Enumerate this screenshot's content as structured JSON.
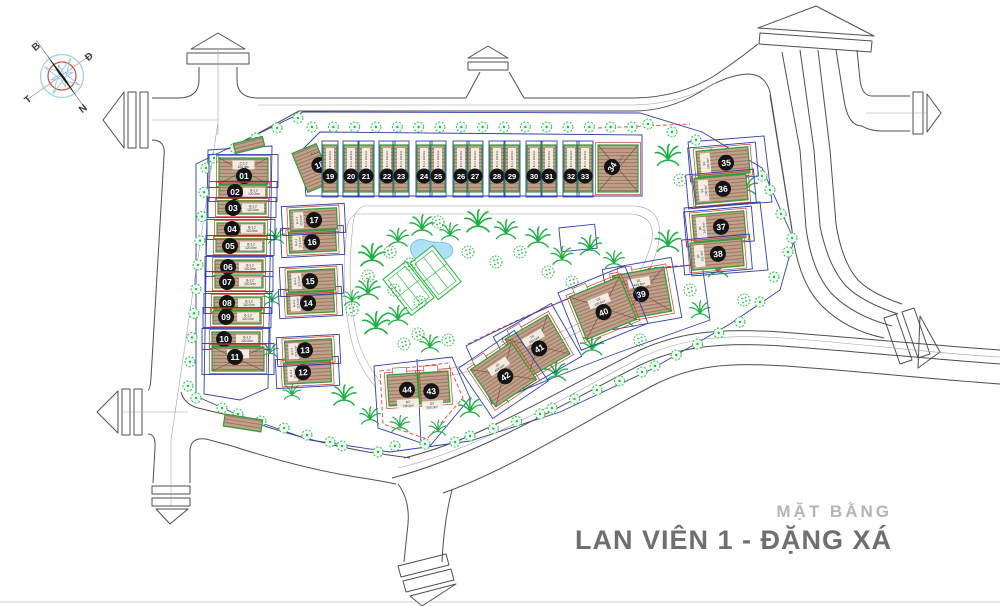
{
  "title_block": {
    "subtitle": "MẶT BẰNG",
    "title": "LAN VIÊN 1 - ĐẶNG XÁ"
  },
  "compass": {
    "north": "B",
    "east": "Đ",
    "west": "T",
    "south": "N"
  },
  "colors": {
    "building_fill": "#c2a18b",
    "building_border": "#2e9e38",
    "lot_line": "#2f3fae",
    "setback_line": "#d92b2b",
    "tree_green": "#28b948",
    "pool_blue": "#aee0f6",
    "road_line": "#4f4f4f",
    "title_gray": "#6f6f6f",
    "subtitle_gray": "#b5b5b5"
  },
  "plan": {
    "park": {
      "features": [
        "swimming-pool",
        "tennis-courts",
        "park-trees"
      ]
    },
    "plots": [
      {
        "no": "01",
        "type": "C-1.2",
        "area": "104.4m²",
        "shape": "hip",
        "bx": 219,
        "by": 158,
        "bw": 49,
        "bh": 26,
        "cx": 244,
        "cy": 176
      },
      {
        "no": "02",
        "type": "B-1.2",
        "area": "120.0m²",
        "shape": "row",
        "bx": 219,
        "by": 185,
        "bw": 48,
        "bh": 13,
        "cx": 235,
        "cy": 192
      },
      {
        "no": "03",
        "type": "B-1.2",
        "area": "120.0m²",
        "shape": "row",
        "bx": 218,
        "by": 201,
        "bw": 48,
        "bh": 13,
        "cx": 233,
        "cy": 208
      },
      {
        "no": "04",
        "type": "B-1.2",
        "area": "120.0m²",
        "shape": "row",
        "bx": 217,
        "by": 223,
        "bw": 48,
        "bh": 13,
        "cx": 232,
        "cy": 229
      },
      {
        "no": "05",
        "type": "B-1.2",
        "area": "120.0m²",
        "shape": "row",
        "bx": 216,
        "by": 239,
        "bw": 48,
        "bh": 13,
        "cx": 230,
        "cy": 246
      },
      {
        "no": "06",
        "type": "B-1.2",
        "area": "120.0m²",
        "shape": "row",
        "bx": 215,
        "by": 260,
        "bw": 48,
        "bh": 13,
        "cx": 228,
        "cy": 267
      },
      {
        "no": "07",
        "type": "B-1.2",
        "area": "120.0m²",
        "shape": "row",
        "bx": 215,
        "by": 275,
        "bw": 48,
        "bh": 13,
        "cx": 227,
        "cy": 282
      },
      {
        "no": "08",
        "type": "B-1.2",
        "area": "120.0m²",
        "shape": "row",
        "bx": 214,
        "by": 297,
        "bw": 48,
        "bh": 13,
        "cx": 227,
        "cy": 303
      },
      {
        "no": "09",
        "type": "B-1.2",
        "area": "120.0m²",
        "shape": "row",
        "bx": 213,
        "by": 311,
        "bw": 48,
        "bh": 13,
        "cx": 226,
        "cy": 317
      },
      {
        "no": "10",
        "type": "B-1.2",
        "area": "120.0m²",
        "shape": "row",
        "bx": 212,
        "by": 332,
        "bw": 48,
        "bh": 14,
        "cx": 224,
        "cy": 339
      },
      {
        "no": "11",
        "type": "C-1.2",
        "area": "110.0m²",
        "shape": "hip",
        "bx": 212,
        "by": 347,
        "bw": 52,
        "bh": 24,
        "cx": 235,
        "cy": 357
      },
      {
        "no": "12",
        "type": "B-2.1",
        "area": "215.0m²",
        "shape": "pairh",
        "bx": 284,
        "by": 362,
        "bw": 47,
        "bh": 21,
        "cx": 303,
        "cy": 372,
        "rot": -3
      },
      {
        "no": "13",
        "type": "B-2.1",
        "area": "215.0m²",
        "shape": "pairh",
        "bx": 285,
        "by": 340,
        "bw": 47,
        "bh": 21,
        "cx": 305,
        "cy": 350,
        "rot": -3
      },
      {
        "no": "14",
        "type": "B-2.1",
        "area": "215.0m²",
        "shape": "pairh",
        "bx": 287,
        "by": 292,
        "bw": 47,
        "bh": 21,
        "cx": 308,
        "cy": 303,
        "rot": -3
      },
      {
        "no": "15",
        "type": "B-2.1",
        "area": "215.0m²",
        "shape": "pairh",
        "bx": 288,
        "by": 270,
        "bw": 47,
        "bh": 21,
        "cx": 310,
        "cy": 281,
        "rot": -3
      },
      {
        "no": "16",
        "type": "B-2.1",
        "area": "215.0m²",
        "shape": "pairh",
        "bx": 289,
        "by": 231,
        "bw": 47,
        "bh": 21,
        "cx": 312,
        "cy": 242,
        "rot": -3
      },
      {
        "no": "17",
        "type": "B-2.1",
        "area": "215.0m²",
        "shape": "pairh",
        "bx": 290,
        "by": 209,
        "bw": 47,
        "bh": 21,
        "cx": 314,
        "cy": 220,
        "rot": -3
      },
      {
        "no": "18",
        "type": "C-1.1",
        "area": "158.0m²",
        "shape": "end",
        "bx": 299,
        "by": 147,
        "bw": 26,
        "bh": 42,
        "cx": 320,
        "cy": 168,
        "rot": -22
      },
      {
        "no": "19",
        "type": "B-1.1",
        "area": "132.5m²",
        "shape": "strip",
        "bx": 323,
        "by": 145,
        "bw": 14,
        "bh": 47,
        "cx": 330,
        "cy": 176
      },
      {
        "no": "20",
        "type": "B-1.1",
        "area": "132.5m²",
        "shape": "strip",
        "bx": 344,
        "by": 145,
        "bw": 14,
        "bh": 47,
        "cx": 351,
        "cy": 176
      },
      {
        "no": "21",
        "type": "B-1.1",
        "area": "132.5m²",
        "shape": "strip",
        "bx": 359,
        "by": 145,
        "bw": 14,
        "bh": 47,
        "cx": 366,
        "cy": 176
      },
      {
        "no": "22",
        "type": "B-1.1",
        "area": "132.5m²",
        "shape": "strip",
        "bx": 380,
        "by": 145,
        "bw": 14,
        "bh": 47,
        "cx": 387,
        "cy": 176
      },
      {
        "no": "23",
        "type": "B-1.1",
        "area": "132.5m²",
        "shape": "strip",
        "bx": 394,
        "by": 145,
        "bw": 14,
        "bh": 47,
        "cx": 401,
        "cy": 176
      },
      {
        "no": "24",
        "type": "B-1.1",
        "area": "132.5m²",
        "shape": "strip",
        "bx": 417,
        "by": 145,
        "bw": 14,
        "bh": 47,
        "cx": 424,
        "cy": 176
      },
      {
        "no": "25",
        "type": "B-1.1",
        "area": "132.5m²",
        "shape": "strip",
        "bx": 431,
        "by": 145,
        "bw": 14,
        "bh": 47,
        "cx": 438,
        "cy": 176
      },
      {
        "no": "26",
        "type": "B-1.1",
        "area": "132.5m²",
        "shape": "strip",
        "bx": 454,
        "by": 145,
        "bw": 14,
        "bh": 47,
        "cx": 461,
        "cy": 176
      },
      {
        "no": "27",
        "type": "B-1.1",
        "area": "132.5m²",
        "shape": "strip",
        "bx": 468,
        "by": 145,
        "bw": 14,
        "bh": 47,
        "cx": 475,
        "cy": 176
      },
      {
        "no": "28",
        "type": "B-1.1",
        "area": "132.5m²",
        "shape": "strip",
        "bx": 490,
        "by": 145,
        "bw": 14,
        "bh": 47,
        "cx": 497,
        "cy": 176
      },
      {
        "no": "29",
        "type": "B-1.1",
        "area": "132.5m²",
        "shape": "strip",
        "bx": 505,
        "by": 145,
        "bw": 14,
        "bh": 47,
        "cx": 512,
        "cy": 176
      },
      {
        "no": "30",
        "type": "B-1.1",
        "area": "132.5m²",
        "shape": "strip",
        "bx": 527,
        "by": 145,
        "bw": 14,
        "bh": 47,
        "cx": 534,
        "cy": 176
      },
      {
        "no": "31",
        "type": "B-1.1",
        "area": "132.5m²",
        "shape": "strip",
        "bx": 542,
        "by": 145,
        "bw": 14,
        "bh": 47,
        "cx": 549,
        "cy": 176
      },
      {
        "no": "32",
        "type": "B-1.1",
        "area": "132.5m²",
        "shape": "strip",
        "bx": 564,
        "by": 145,
        "bw": 14,
        "bh": 47,
        "cx": 571,
        "cy": 176
      },
      {
        "no": "33",
        "type": "B-1.1",
        "area": "132.5m²",
        "shape": "strip",
        "bx": 578,
        "by": 145,
        "bw": 14,
        "bh": 47,
        "cx": 585,
        "cy": 176
      },
      {
        "no": "34",
        "type": "C-1.1",
        "area": "158.0m²",
        "shape": "hip34",
        "bx": 598,
        "by": 145,
        "bw": 40,
        "bh": 47,
        "cx": 612,
        "cy": 167,
        "nrot": -60
      },
      {
        "no": "35",
        "type": "B1",
        "area": "265.5m²",
        "shape": "pairh",
        "bx": 697,
        "by": 149,
        "bw": 52,
        "bh": 26,
        "cx": 726,
        "cy": 163,
        "rot": -5
      },
      {
        "no": "36",
        "type": "B1",
        "area": "240.5m²",
        "shape": "pairh",
        "bx": 695,
        "by": 176,
        "bw": 52,
        "bh": 26,
        "cx": 723,
        "cy": 189,
        "rot": -5
      },
      {
        "no": "37",
        "type": "B1",
        "area": "241.5m²",
        "shape": "pairh",
        "bx": 693,
        "by": 213,
        "bw": 52,
        "bh": 27,
        "cx": 721,
        "cy": 227,
        "rot": -5
      },
      {
        "no": "38",
        "type": "B1",
        "area": "291.3m²",
        "shape": "pairh",
        "bx": 691,
        "by": 241,
        "bw": 52,
        "bh": 27,
        "cx": 718,
        "cy": 254,
        "rot": -5
      },
      {
        "no": "39",
        "type": "D1",
        "area": "443.6m²",
        "shape": "villa",
        "bx": 616,
        "by": 271,
        "bw": 52,
        "bh": 45,
        "cx": 641,
        "cy": 294,
        "rot": -10
      },
      {
        "no": "40",
        "type": "D1",
        "area": "429.5m²",
        "shape": "villa",
        "bx": 576,
        "by": 285,
        "bw": 54,
        "bh": 46,
        "cx": 602,
        "cy": 312,
        "rot": -22
      },
      {
        "no": "41",
        "type": "D1",
        "area": "434.5m²",
        "shape": "villa",
        "bx": 513,
        "by": 324,
        "bw": 49,
        "bh": 45,
        "cx": 538,
        "cy": 349,
        "rot": -30
      },
      {
        "no": "42",
        "type": "D1",
        "area": "448.5m²",
        "shape": "villa",
        "bx": 479,
        "by": 352,
        "bw": 49,
        "bh": 45,
        "cx": 504,
        "cy": 377,
        "rot": -34
      },
      {
        "no": "43",
        "type": "D2",
        "area": "500.0m²",
        "shape": "villas",
        "bx": 419,
        "by": 372,
        "bw": 30,
        "bh": 31,
        "cx": 431,
        "cy": 391,
        "rot": -4
      },
      {
        "no": "44",
        "type": "D2",
        "area": "736.0m²",
        "shape": "villas",
        "bx": 388,
        "by": 374,
        "bw": 30,
        "bh": 31,
        "cx": 407,
        "cy": 390,
        "rot": -4
      }
    ]
  }
}
